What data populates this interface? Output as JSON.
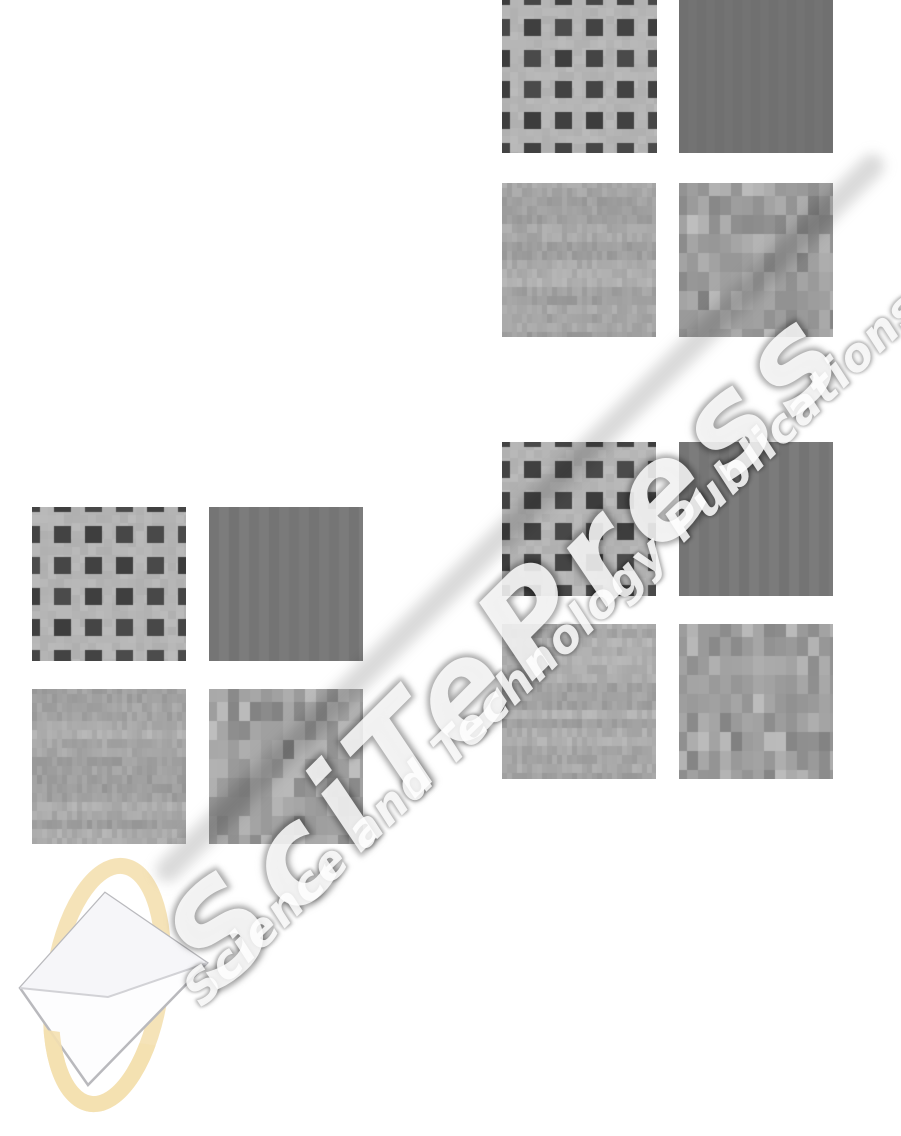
{
  "page": {
    "width": 901,
    "height": 1136,
    "background": "#ffffff"
  },
  "watermark": {
    "title": "SciTePress",
    "subtitle": "Science and Technology Publications",
    "ink_color": "#969696",
    "highlight_color": "#ffffff"
  },
  "logo": {
    "label": "SciTePress logo",
    "ring_color": "#f4e0b0",
    "book_fill": "#fdfdfe",
    "book_top_fill": "#f6f6f9",
    "book_stroke": "#b9b9bd",
    "fold_stroke": "#d2d2d6"
  },
  "figure": {
    "description": "Three 2x2 groups of grayscale texture patches",
    "groups": [
      {
        "name": "top-right",
        "patches": [
          {
            "slot": "top-left",
            "type": "checkerboard",
            "label": "checkered weave texture"
          },
          {
            "slot": "top-right",
            "type": "uniform",
            "label": "uniform gray patch"
          },
          {
            "slot": "bottom-left",
            "type": "fine_noise",
            "label": "fine vertical grain noise"
          },
          {
            "slot": "bottom-right",
            "type": "block_noise",
            "label": "coarse block noise"
          }
        ]
      },
      {
        "name": "middle-right",
        "patches": [
          {
            "slot": "top-left",
            "type": "checkerboard",
            "label": "checkered weave texture"
          },
          {
            "slot": "top-right",
            "type": "stripes",
            "label": "vertical stripe texture"
          },
          {
            "slot": "bottom-left",
            "type": "fine_noise",
            "label": "fine vertical grain noise"
          },
          {
            "slot": "bottom-right",
            "type": "block_noise",
            "label": "coarse block noise"
          }
        ]
      },
      {
        "name": "left",
        "patches": [
          {
            "slot": "top-left",
            "type": "checkerboard",
            "label": "checkered weave texture"
          },
          {
            "slot": "top-right",
            "type": "stripes",
            "label": "vertical stripe texture"
          },
          {
            "slot": "bottom-left",
            "type": "fine_noise",
            "label": "fine vertical grain noise"
          },
          {
            "slot": "bottom-right",
            "type": "block_noise",
            "label": "coarse block noise"
          }
        ]
      }
    ]
  },
  "textures": {
    "checkerboard": {
      "background": "#b5b5b5",
      "square": "#414141",
      "pitch": 31,
      "square_size": 17
    },
    "uniform": {
      "fill": "#717171",
      "band_width": 9
    },
    "stripes": {
      "dark": "#747474",
      "light": "#7b7b7b",
      "stripe_width": 10
    },
    "fine_noise": {
      "min": "#9a9a9a",
      "max": "#bdbdbd",
      "cell_w": 5,
      "cell_h": 9
    },
    "block_noise": {
      "min": "#7d7d7d",
      "max": "#c2c2c2",
      "cell_w": 11,
      "cell_h": 19
    }
  }
}
